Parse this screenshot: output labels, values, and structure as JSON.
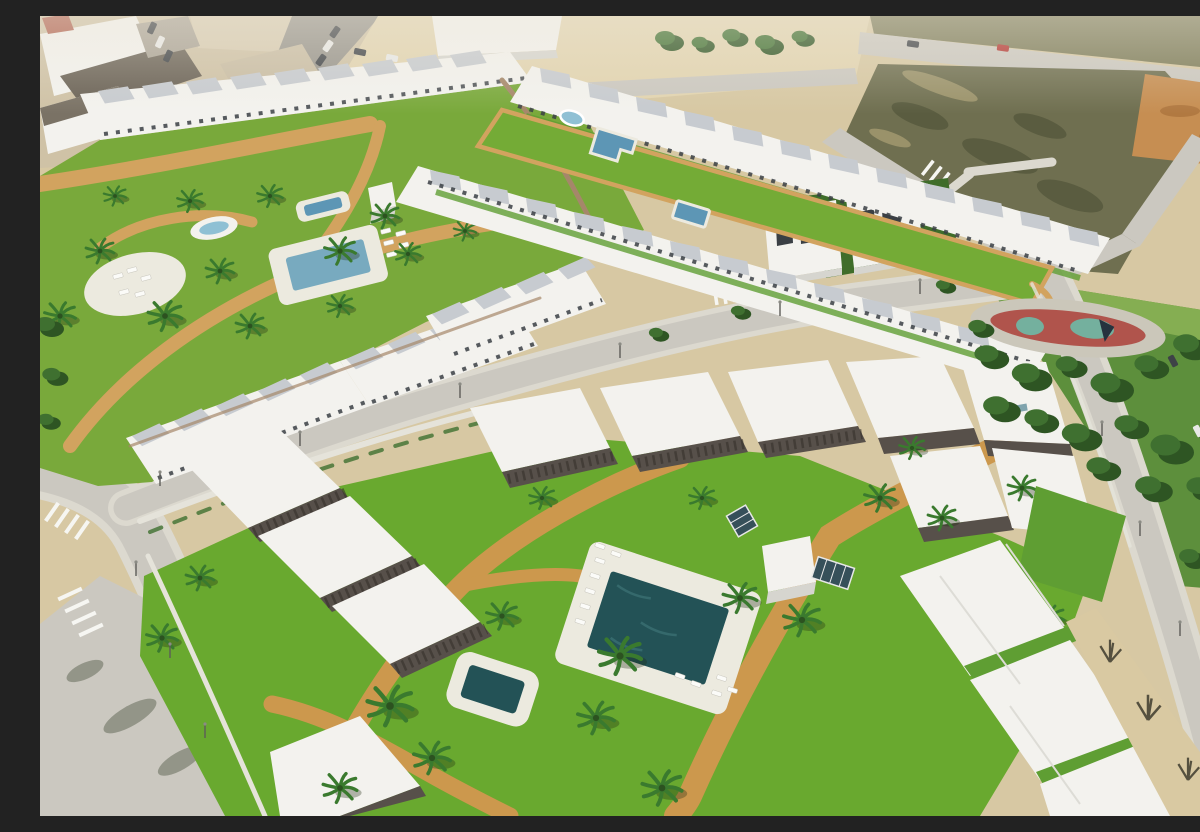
{
  "scene": {
    "type": "aerial-architectural-render",
    "description": "Aerial 3D render of a new-build residential development: rows of white townhouses and apartment blocks with dark pergolas around communal lawns with swimming pools, spa, sun decks, loungers and palm trees; a long landscaped pool strip between two townhouse rows; two detached villas; surrounding light-grey streets with zebra crossings and street lamps; an existing town edge with parked cars at top-left; a vacant scrubland lot and orange dirt at top-right; a public pine-tree park with a red rubber playground at the right; no visible text in the image.",
    "features": [
      "existing-town",
      "vacant-sand-strip",
      "warehouse",
      "scrubland-lot",
      "orange-dirt-patch",
      "upper-left-complex",
      "communal-lawn",
      "main-pool",
      "raised-spa",
      "oval-fountain",
      "circular-sun-deck",
      "pool-strip-complex",
      "l-shaped-pool",
      "round-fountain",
      "square-plunge-pool",
      "detached-villas",
      "pine-park",
      "playground",
      "foreground-complex",
      "foreground-main-pool",
      "foreground-square-pool",
      "sun-loungers",
      "palm-trees",
      "tan-walkways",
      "streets",
      "zebra-crossings",
      "road-arrow-marking",
      "street-lamps",
      "parked-cars"
    ]
  },
  "palette": {
    "sand": "#d7c8a3",
    "sandLight": "#e2d4b0",
    "roadLight": "#cbc8c0",
    "sidewalk": "#dcd9cf",
    "townStreet": "#97948c",
    "townBeige": "#cfc2a6",
    "white": "#f3f2ee",
    "shade": "#d6d5cf",
    "roofGray": "#c7cbd0",
    "roofDark": "#6b6357",
    "pergola": "#57504a",
    "pergolaDark": "#35312b",
    "brick": "#a5876a",
    "grass": "#69a92f",
    "grassYellow": "#79a93b",
    "grassStrip": "#74ab36",
    "grassDark": "#5f9e33",
    "parkGreen": "#5d8f3c",
    "parkLight": "#85ae52",
    "villaLawn": "#3f6d2a",
    "scrub": "#6f6f50",
    "scrubDark": "#5a5c40",
    "scrubTop": "#7d7c59",
    "dirt": "#c68e52",
    "path": "#d2a35f",
    "pathOrange": "#cc984d",
    "deck": "#eceadf",
    "poolDark": "#235256",
    "poolBlue": "#5d96b5",
    "poolLight": "#8fc0d4",
    "poolPale": "#78aabf",
    "treeDark": "#2e5523",
    "treeMid": "#3f7030",
    "palmGreen": "#3a7a2e",
    "playRed": "#b0544c",
    "playTeal": "#74b09e",
    "playApron": "#cbc7ba",
    "carRed": "#b23430",
    "carDark": "#3e4247",
    "carWhite": "#e9e9e7",
    "window": "#3a3f44",
    "wallWhite": "#e5e3da",
    "sandSidewalk": "#d9c9a2",
    "shadow": "rgba(30,42,20,0.32)",
    "haze": "rgba(238,232,218,0.45)",
    "bare": "#55503f"
  }
}
